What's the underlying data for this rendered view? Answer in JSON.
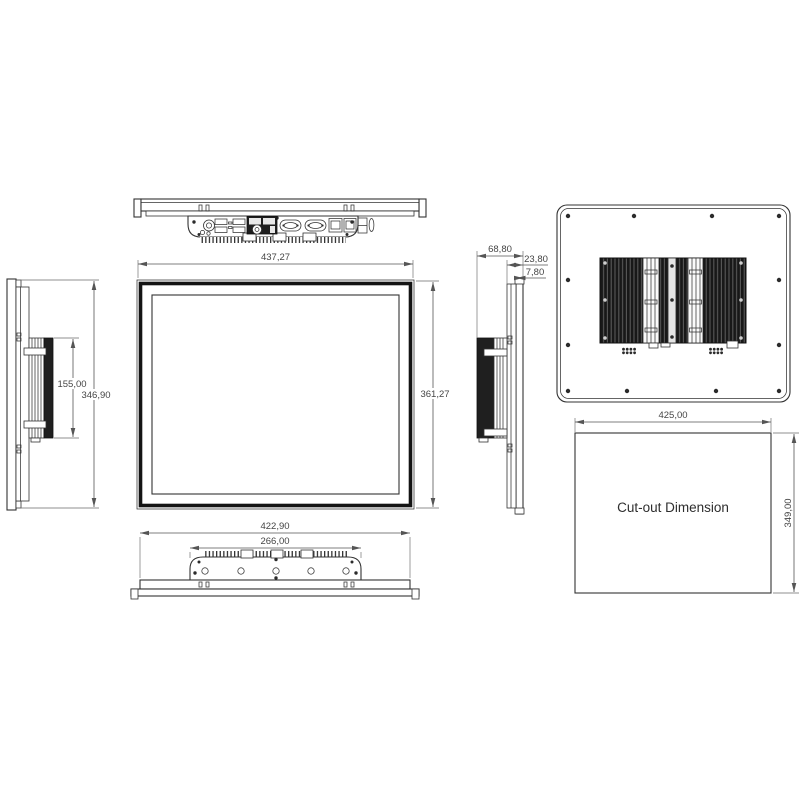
{
  "views": {
    "front": {
      "width_mm": "437,27",
      "height_mm": "361,27"
    },
    "left_side": {
      "heatsink_height_mm": "155,00",
      "overall_height_mm": "346,90"
    },
    "right_side": {
      "overall_depth_mm": "68,80",
      "chassis_depth_mm": "23,80",
      "bezel_depth_mm": "7,80"
    },
    "bottom": {
      "overall_width_mm": "422,90",
      "heatsink_width_mm": "266,00"
    },
    "cutout": {
      "label": "Cut-out Dimension",
      "width_mm": "425,00",
      "height_mm": "349,00"
    }
  },
  "colors": {
    "line": "#333333",
    "dimension": "#4d4d4d",
    "heatsink_fill": "#1b1b1b",
    "background": "#ffffff"
  }
}
